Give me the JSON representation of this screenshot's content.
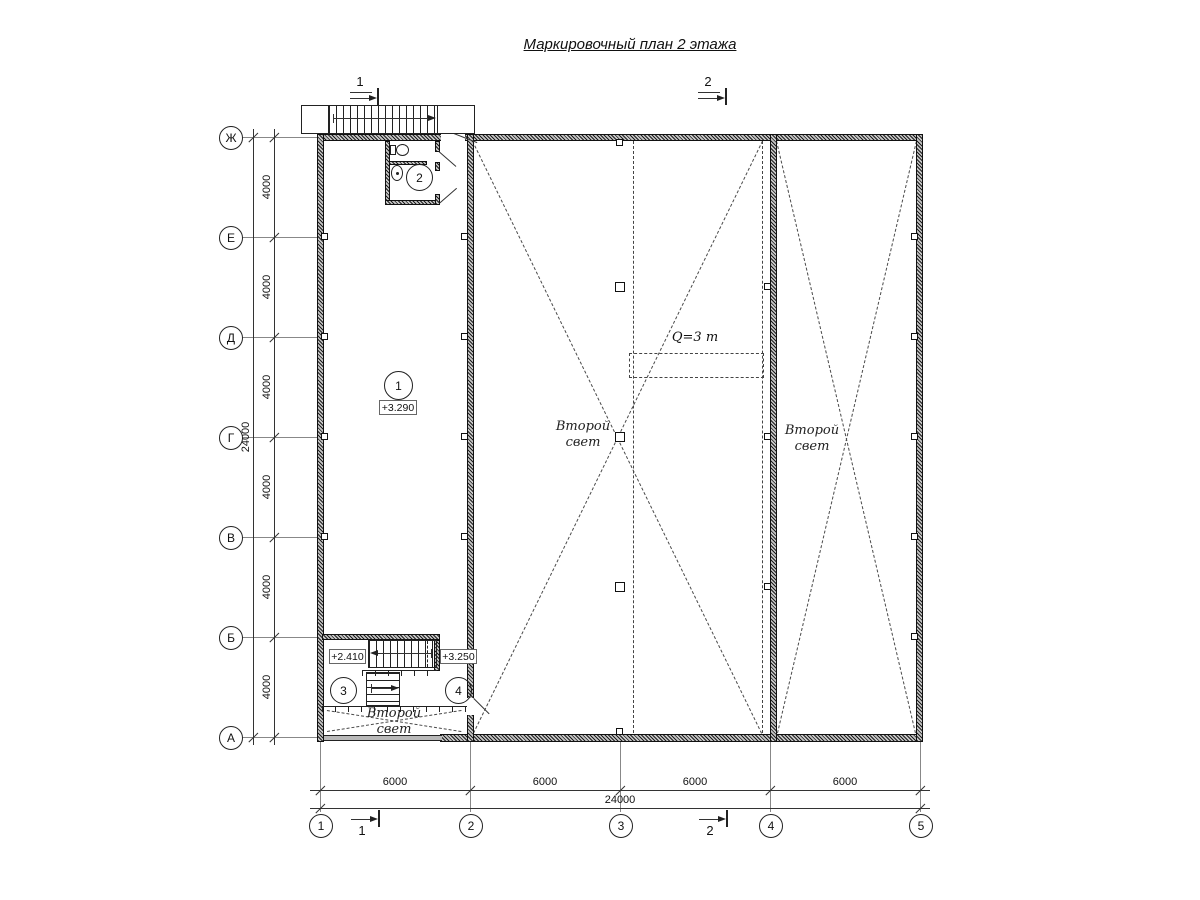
{
  "title": "Маркировочный план 2 этажа",
  "section_marks": {
    "top_left": "1",
    "top_right": "2",
    "bottom_left": "1",
    "bottom_right": "2"
  },
  "axes": {
    "rows": [
      {
        "label": "Ж"
      },
      {
        "label": "Е"
      },
      {
        "label": "Д"
      },
      {
        "label": "Г"
      },
      {
        "label": "В"
      },
      {
        "label": "Б"
      },
      {
        "label": "А"
      }
    ],
    "cols": [
      {
        "label": "1"
      },
      {
        "label": "2"
      },
      {
        "label": "3"
      },
      {
        "label": "4"
      },
      {
        "label": "5"
      }
    ]
  },
  "dimensions": {
    "vertical": {
      "segments": [
        "4000",
        "4000",
        "4000",
        "4000",
        "4000",
        "4000"
      ],
      "overall": "24000"
    },
    "horizontal": {
      "segments": [
        "6000",
        "6000",
        "6000",
        "6000"
      ],
      "overall": "24000"
    }
  },
  "rooms": {
    "room1": {
      "number": "1",
      "elevation": "+3.290"
    },
    "room2": {
      "number": "2"
    },
    "room3": {
      "number": "3",
      "elevation": "+2.410"
    },
    "room4": {
      "number": "4",
      "elevation": "+3.250"
    }
  },
  "labels": {
    "crane_capacity": "Q=3 т",
    "double_height": "Второй свет"
  }
}
